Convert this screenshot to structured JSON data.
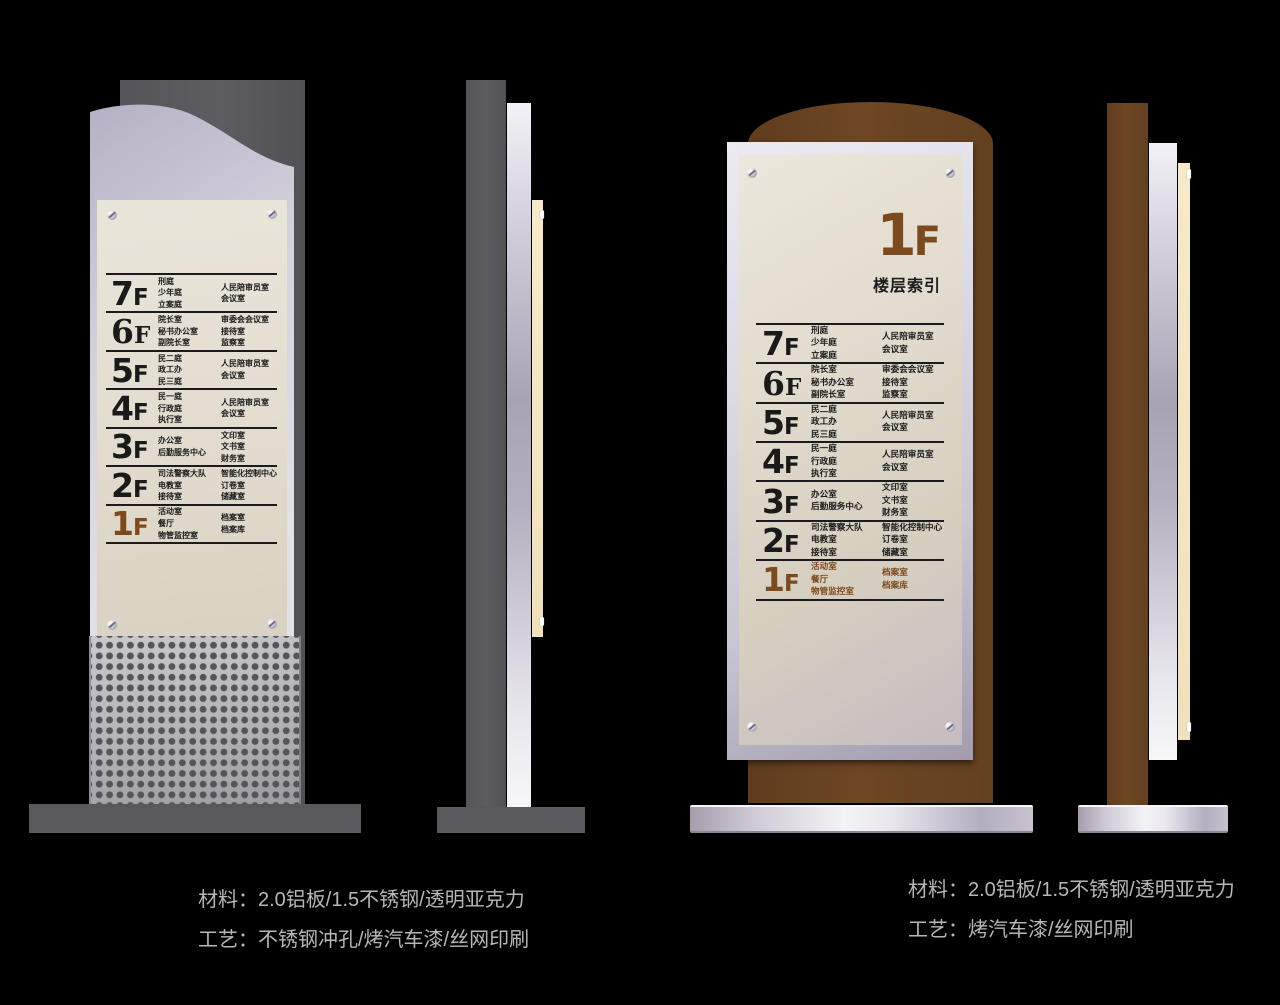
{
  "directory": {
    "floors": [
      {
        "num": "7",
        "suffix": "F",
        "serif": false,
        "brown": false,
        "col1": [
          "刑庭",
          "少年庭",
          "立案庭"
        ],
        "col2": [
          "人民陪审员室",
          "会议室"
        ]
      },
      {
        "num": "6",
        "suffix": "F",
        "serif": true,
        "brown": false,
        "col1": [
          "院长室",
          "秘书办公室",
          "副院长室"
        ],
        "col2": [
          "审委会会议室",
          "接待室",
          "监察室"
        ]
      },
      {
        "num": "5",
        "suffix": "F",
        "serif": false,
        "brown": false,
        "col1": [
          "民二庭",
          "政工办",
          "民三庭"
        ],
        "col2": [
          "人民陪审员室",
          "会议室"
        ]
      },
      {
        "num": "4",
        "suffix": "F",
        "serif": false,
        "brown": false,
        "col1": [
          "民一庭",
          "行政庭",
          "执行室"
        ],
        "col2": [
          "人民陪审员室",
          "会议室"
        ]
      },
      {
        "num": "3",
        "suffix": "F",
        "serif": false,
        "brown": false,
        "col1": [
          "办公室",
          "后勤服务中心"
        ],
        "col2": [
          "文印室",
          "文书室",
          "财务室"
        ]
      },
      {
        "num": "2",
        "suffix": "F",
        "serif": false,
        "brown": false,
        "col1": [
          "司法警察大队",
          "电教室",
          "接待室"
        ],
        "col2": [
          "智能化控制中心",
          "订卷室",
          "储藏室"
        ]
      },
      {
        "num": "1",
        "suffix": "F",
        "serif": false,
        "brown": true,
        "col1": [
          "活动室",
          "餐厅",
          "物管监控室"
        ],
        "col2": [
          "档案室",
          "档案库"
        ]
      }
    ]
  },
  "right_sign": {
    "title_num": "1",
    "title_suffix": "F",
    "subtitle": "楼层索引"
  },
  "captions": {
    "left": {
      "line1": "材料：2.0铝板/1.5不锈钢/透明亚克力",
      "line2": "工艺：不锈钢冲孔/烤汽车漆/丝网印刷"
    },
    "right": {
      "line1": "材料：2.0铝板/1.5不锈钢/透明亚克力",
      "line2": "工艺：烤汽车漆/丝网印刷"
    }
  },
  "colors": {
    "background": "#000000",
    "steel_gray": "#59595d",
    "wood_brown": "#6a4423",
    "accent_brown_text": "#7b4a1e",
    "cream_panel": "#e3ddd0",
    "acrylic_lavender": "#d3cfdb",
    "caption_gray": "#b7b7b7",
    "ink_black": "#1a1a1a"
  }
}
